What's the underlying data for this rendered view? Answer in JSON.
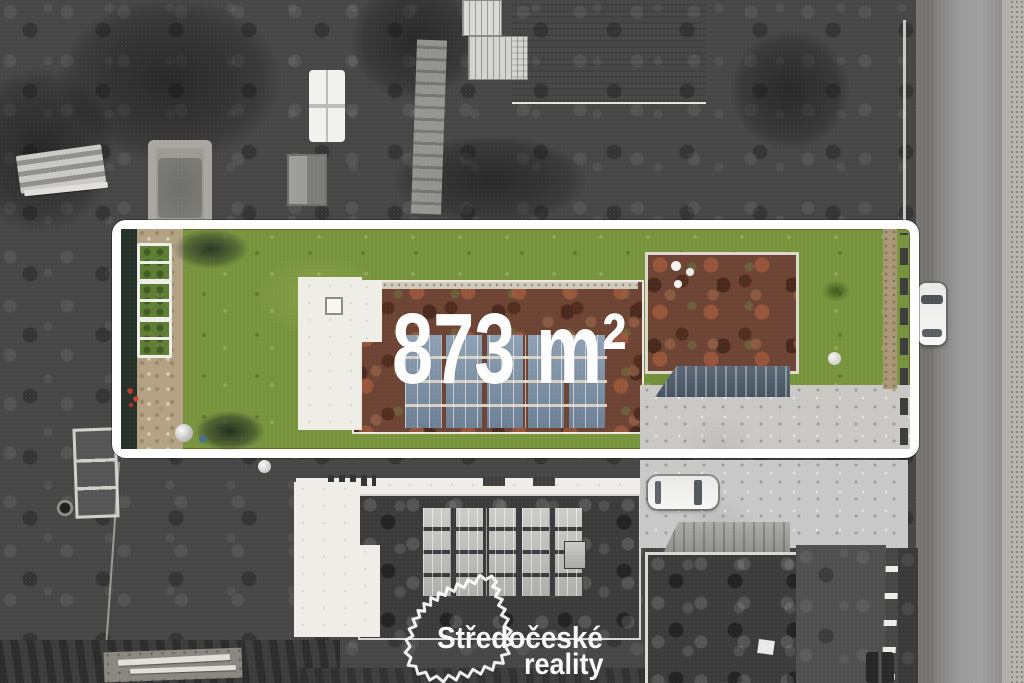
{
  "area_label": {
    "text": "873 m²"
  },
  "watermark": {
    "line1": "Středočeské",
    "line2": "reality"
  },
  "colors": {
    "highlight_border": "#ffffff",
    "lawn_green": "#78933e",
    "sedum_roof_red": "#6d4334",
    "white_flat_roof": "#eeede8",
    "solar_panel_blue": "#7e92a6",
    "driveway_concrete": "#c9c8c4",
    "road_asphalt": "#8f8f8f",
    "surroundings_grayscale": "#464646",
    "label_text": "#ffffff",
    "flower_red": "#c4392f"
  }
}
